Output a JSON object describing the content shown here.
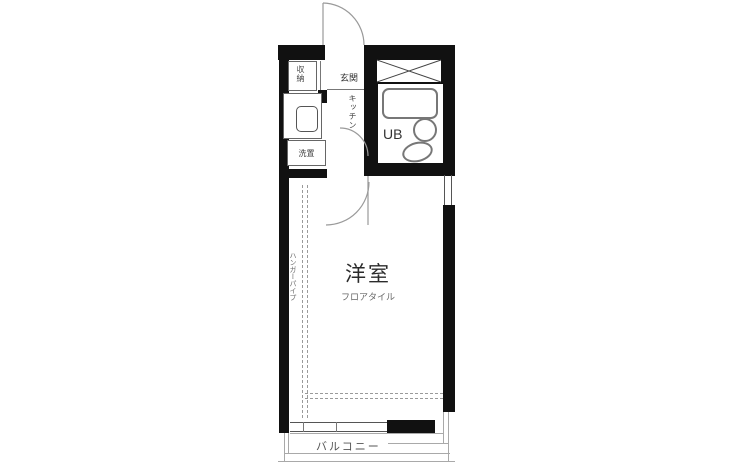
{
  "floorplan": {
    "labels": {
      "entrance": "玄関",
      "storage": "収納",
      "kitchen": "キッチン",
      "laundry": "洗置",
      "unit_bath": "UB",
      "main_room": "洋室",
      "floor_type": "フロアタイル",
      "hanger_pipe": "ハンガーパイプ",
      "balcony": "バルコニー"
    },
    "colors": {
      "wall": "#111111",
      "fixture_line": "#777777",
      "guide_line": "#9a9a9a",
      "text": "#333333"
    }
  }
}
